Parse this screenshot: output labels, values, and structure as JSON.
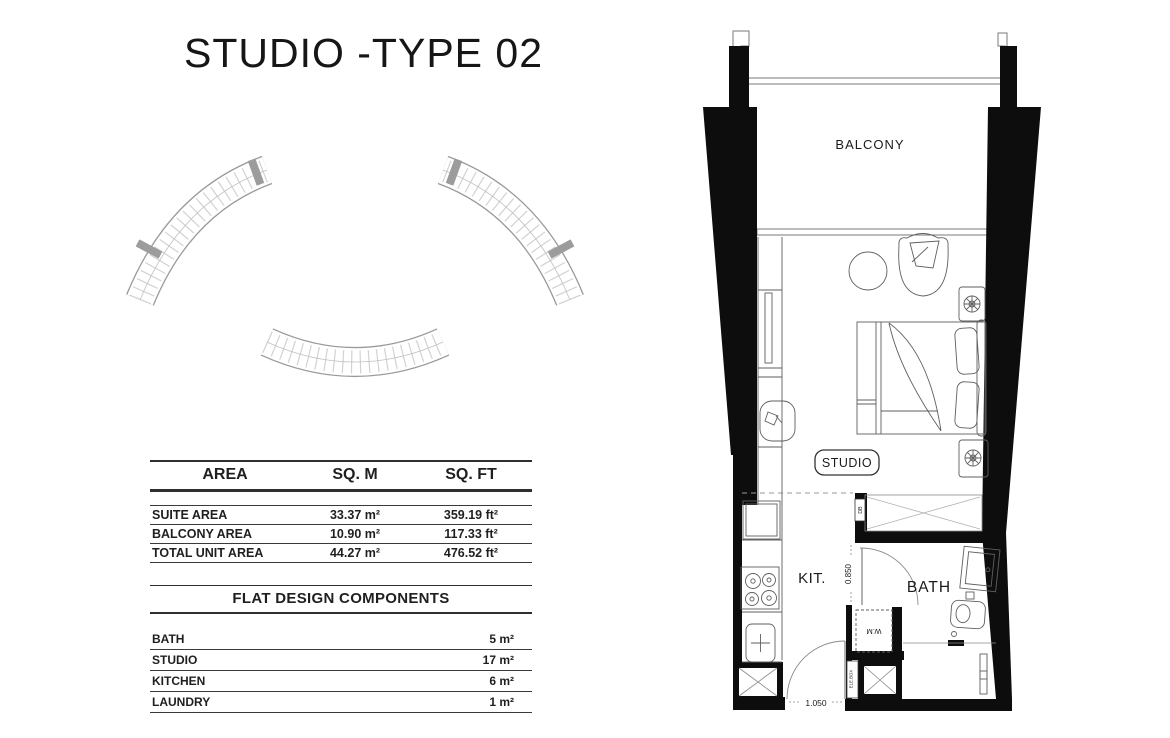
{
  "title": "STUDIO -TYPE 02",
  "area_table": {
    "headers": [
      "AREA",
      "SQ. M",
      "SQ. FT"
    ],
    "rows": [
      {
        "label": "SUITE AREA",
        "sqm": "33.37 m²",
        "sqft": "359.19 ft²"
      },
      {
        "label": "BALCONY AREA",
        "sqm": "10.90 m²",
        "sqft": "117.33 ft²"
      },
      {
        "label": "TOTAL UNIT AREA",
        "sqm": "44.27 m²",
        "sqft": "476.52 ft²"
      }
    ]
  },
  "components": {
    "title": "FLAT DESIGN COMPONENTS",
    "rows": [
      {
        "label": "BATH",
        "value": "5 m²"
      },
      {
        "label": "STUDIO",
        "value": "17 m²"
      },
      {
        "label": "KITCHEN",
        "value": "6 m²"
      },
      {
        "label": "LAUNDRY",
        "value": "1 m²"
      }
    ]
  },
  "floor_plan": {
    "labels": {
      "balcony": "BALCONY",
      "studio": "STUDIO",
      "kitchen": "KIT.",
      "bath": "BATH",
      "washing_machine": "W.M",
      "distribution_board": "DB",
      "electrical_box": "ELE.BOX"
    },
    "dimensions": {
      "entry_width": "1.050",
      "corridor_width": "0.850"
    }
  },
  "colors": {
    "wall": "#0d0d0d",
    "furniture_line": "#5f5f5f",
    "site_outline": "#9a9a9a",
    "highlight_unit": "#9c9c9c"
  }
}
